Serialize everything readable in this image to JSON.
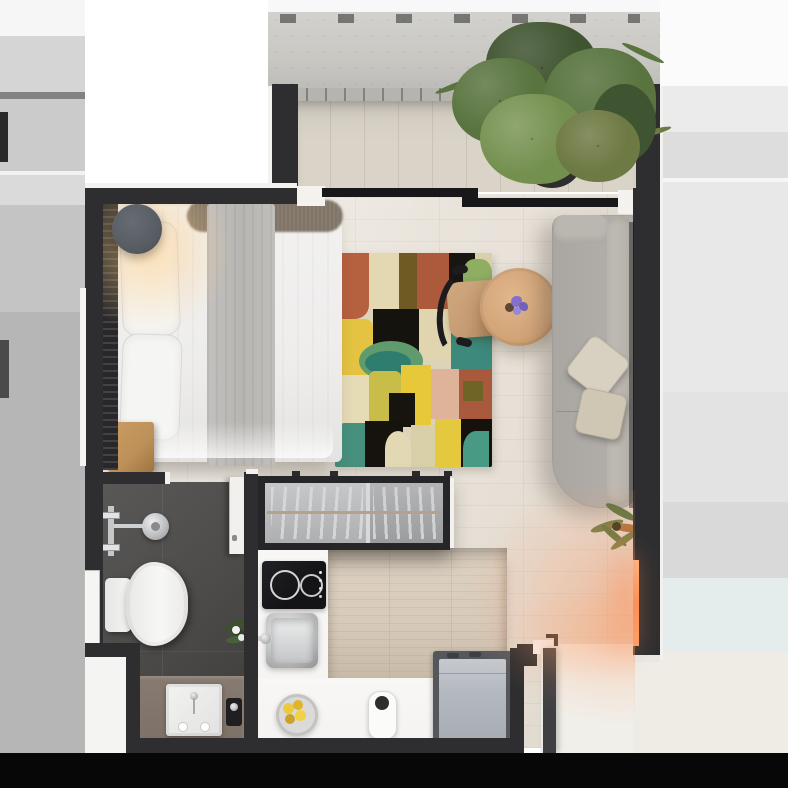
{
  "meta": {
    "type": "floor-plan-render",
    "description": "Top-down 3D render of a studio apartment floor plan",
    "width_px": 788,
    "height_px": 788
  },
  "colors": {
    "wall": "#2e2e30",
    "wallDark": "#1d1d1f",
    "trim": "#f3f2ef",
    "blackBand": "#070707",
    "parapet": "#c9c8c3",
    "deck": "#d9d3c8",
    "rail": "#b5b4af",
    "floor": "#e8e2d9",
    "bathFloor": "#4f4d4b",
    "bathFloorDark": "#3f3d3c",
    "bathCounter": "#7e7268",
    "counter": "#f4f3f1",
    "cooktop": "#141417",
    "woodTable": "#d7caba",
    "fridgeFrame": "#54585d",
    "fridgeBody": "#b4b9bf",
    "sofa": "#b0ada8",
    "sofaBolster": "#c2beb7",
    "cushion": "#d8d1c1",
    "bedWhite": "#eeedec",
    "bedThrow": "#b8b6b3",
    "fur": "#847a6e",
    "nightstand": "#bd9059",
    "lampGray": "#585d64",
    "rugBase": "#ddd3b8",
    "chairWood": "#c59b73",
    "chairFrame": "#1c1c1e",
    "tableWood": "#d2a478",
    "flower": "#8471cf",
    "curtain": "#28282a",
    "glassPanel": "#b4b5b7",
    "hangerRail": "#b3a28d",
    "plantDark": "#3f5430",
    "plantMid": "#59743f",
    "plantLight": "#74904f",
    "plantOlive": "#6e7a44",
    "potDark": "#2e2e2c",
    "glow": "#ff8f57",
    "doorLeaf": "#3f3f42",
    "landing": "#f1efe9",
    "porcelain": "#f5f5f3"
  },
  "rooms": {
    "balcony": {
      "objects": [
        "potted-plant",
        "parapet-wall",
        "railing",
        "wood-deck"
      ]
    },
    "living_bedroom": {
      "objects": [
        "double-bed",
        "pillows",
        "fur-throw",
        "gray-runner",
        "wall-lamp",
        "nightstand",
        "curtain",
        "area-rug",
        "desk-chair",
        "round-coffee-table",
        "flower-vase",
        "chaise-sofa",
        "throw-pillows",
        "floor-plant",
        "wardrobe-closet",
        "led-light-strip",
        "sliding-glass-door"
      ]
    },
    "bathroom": {
      "objects": [
        "shower-head",
        "shower-valve",
        "toilet",
        "vanity-counter",
        "vanity-sink",
        "soap-dispenser",
        "small-plant",
        "window",
        "bathroom-door"
      ]
    },
    "kitchen": {
      "objects": [
        "induction-cooktop",
        "kitchen-sink",
        "faucet",
        "wood-counter-table",
        "fruit-bowl",
        "kettle",
        "refrigerator"
      ]
    },
    "entry": {
      "objects": [
        "entry-door",
        "door-landing",
        "threshold"
      ]
    }
  },
  "rug": {
    "cells": [
      {
        "x": 0,
        "y": 0,
        "w": 34,
        "h": 66,
        "c": "#b5603f",
        "r": "0 0 14px 0"
      },
      {
        "x": 34,
        "y": 0,
        "w": 30,
        "h": 56,
        "c": "#e3d8b2",
        "r": "0"
      },
      {
        "x": 64,
        "y": 0,
        "w": 18,
        "h": 60,
        "c": "#6f5a24",
        "r": "0"
      },
      {
        "x": 82,
        "y": 0,
        "w": 32,
        "h": 56,
        "c": "#ad5a3c",
        "r": "0"
      },
      {
        "x": 114,
        "y": 0,
        "w": 26,
        "h": 62,
        "c": "#191611",
        "r": "0"
      },
      {
        "x": 140,
        "y": 0,
        "w": 17,
        "h": 56,
        "c": "#d9cfa8",
        "r": "0"
      },
      {
        "x": 128,
        "y": 6,
        "w": 29,
        "h": 34,
        "c": "#8fae62",
        "r": "40%"
      },
      {
        "x": 138,
        "y": 40,
        "w": 19,
        "h": 52,
        "c": "#e0b49c",
        "r": "0"
      },
      {
        "x": 0,
        "y": 66,
        "w": 38,
        "h": 56,
        "c": "#e3c341",
        "r": "8px"
      },
      {
        "x": 38,
        "y": 56,
        "w": 46,
        "h": 62,
        "c": "#15130e",
        "r": "0"
      },
      {
        "x": 84,
        "y": 56,
        "w": 32,
        "h": 50,
        "c": "#e0d5ae",
        "r": "0"
      },
      {
        "x": 116,
        "y": 62,
        "w": 41,
        "h": 58,
        "c": "#3d8a7c",
        "r": "0"
      },
      {
        "x": 24,
        "y": 88,
        "w": 64,
        "h": 40,
        "c": "#5f9b6d",
        "r": "50%"
      },
      {
        "x": 30,
        "y": 98,
        "w": 46,
        "h": 24,
        "c": "#2f7d6e",
        "r": "50%"
      },
      {
        "x": 0,
        "y": 122,
        "w": 34,
        "h": 48,
        "c": "#e5dcb6",
        "r": "0"
      },
      {
        "x": 34,
        "y": 118,
        "w": 32,
        "h": 54,
        "c": "#c9bd4a",
        "r": "6px"
      },
      {
        "x": 66,
        "y": 112,
        "w": 30,
        "h": 62,
        "c": "#e6c838",
        "r": "0"
      },
      {
        "x": 96,
        "y": 116,
        "w": 28,
        "h": 50,
        "c": "#dfb29a",
        "r": "0"
      },
      {
        "x": 124,
        "y": 116,
        "w": 33,
        "h": 52,
        "c": "#aa5a3c",
        "r": "0"
      },
      {
        "x": 128,
        "y": 128,
        "w": 20,
        "h": 20,
        "c": "#6f6426",
        "r": "0"
      },
      {
        "x": 54,
        "y": 140,
        "w": 26,
        "h": 34,
        "c": "#17140f",
        "r": "0"
      },
      {
        "x": 0,
        "y": 170,
        "w": 30,
        "h": 44,
        "c": "#47907e",
        "r": "10px 0 0 0"
      },
      {
        "x": 30,
        "y": 168,
        "w": 38,
        "h": 46,
        "c": "#16130e",
        "r": "0"
      },
      {
        "x": 50,
        "y": 178,
        "w": 26,
        "h": 36,
        "c": "#e2d8b4",
        "r": "50% 50% 0 0"
      },
      {
        "x": 76,
        "y": 172,
        "w": 24,
        "h": 42,
        "c": "#d9cfa8",
        "r": "0"
      },
      {
        "x": 100,
        "y": 166,
        "w": 26,
        "h": 48,
        "c": "#e4c93f",
        "r": "0"
      },
      {
        "x": 126,
        "y": 166,
        "w": 31,
        "h": 48,
        "c": "#15120d",
        "r": "0"
      },
      {
        "x": 128,
        "y": 178,
        "w": 26,
        "h": 36,
        "c": "#499a85",
        "r": "50% 0 0 0"
      }
    ]
  }
}
